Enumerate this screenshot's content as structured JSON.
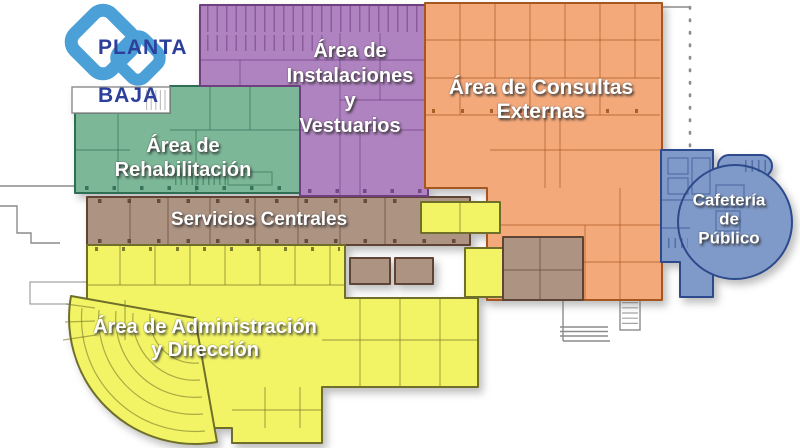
{
  "title": {
    "lines": [
      "PLANTA",
      "BAJA"
    ],
    "color": "#2B3F9B",
    "logo_color": "#4BA0D8"
  },
  "label_text_color": "#FFFFFF",
  "outline_color": "#8C8C8C",
  "regions": {
    "rehabilitacion": {
      "name": "Área de Rehabilitación",
      "lines": [
        "Área de",
        "Rehabilitación"
      ],
      "fill": "#7CB797",
      "stroke": "#2E6E54"
    },
    "instalaciones": {
      "name": "Área de Instalaciones y Vestuarios",
      "lines": [
        "Área de",
        "Instalaciones",
        "y",
        "Vestuarios"
      ],
      "fill": "#AF82C0",
      "stroke": "#6E4080"
    },
    "consultas": {
      "name": "Área de Consultas Externas",
      "lines": [
        "Área de Consultas",
        "Externas"
      ],
      "fill": "#F4A97B",
      "stroke": "#A6561E"
    },
    "servicios": {
      "name": "Servicios Centrales",
      "lines": [
        "Servicios Centrales"
      ],
      "fill": "#AD9382",
      "stroke": "#5F4334"
    },
    "administracion": {
      "name": "Área de Administración y Dirección",
      "lines": [
        "Área de Administración",
        "y Dirección"
      ],
      "fill": "#F2F465",
      "stroke": "#6F6F2A"
    },
    "cafeteria": {
      "name": "Cafetería de Público",
      "lines": [
        "Cafetería",
        "de",
        "Público"
      ],
      "fill": "#7F99C8",
      "stroke": "#2C4A8C"
    }
  }
}
